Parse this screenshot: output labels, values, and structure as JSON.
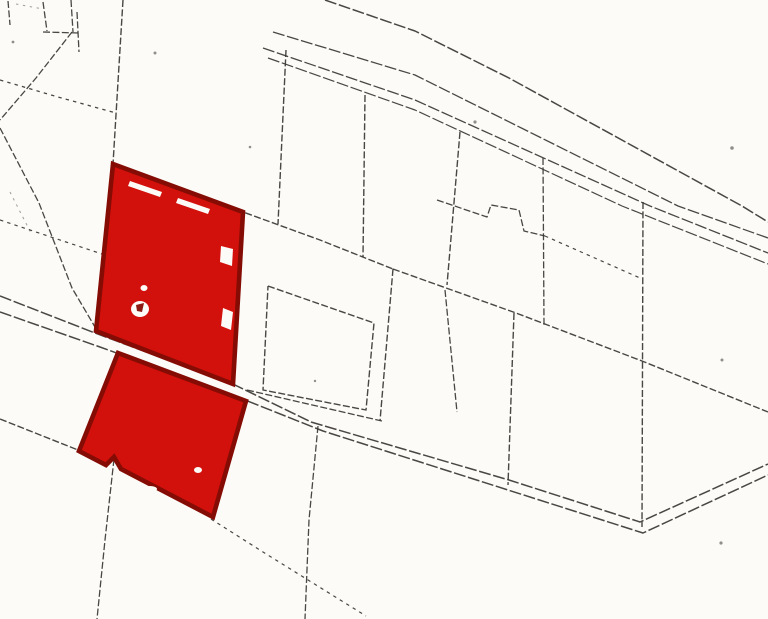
{
  "canvas": {
    "width": 768,
    "height": 619
  },
  "palette": {
    "paper": "#fcfbf8",
    "line": "#3b3733",
    "line_faint": "#918d86",
    "parcel_fill": "#d2100c",
    "parcel_border": "#850c04",
    "scan_mark": "#8d1a12",
    "speck": "#6f6b66"
  },
  "map": {
    "highlighted_parcels": [
      {
        "name": "highlighted-parcel-upper",
        "pts": [
          [
            113,
            164
          ],
          [
            243,
            212
          ],
          [
            233,
            384
          ],
          [
            96,
            331
          ]
        ]
      },
      {
        "name": "highlighted-parcel-lower",
        "pts": [
          [
            118,
            353
          ],
          [
            246,
            401
          ],
          [
            213,
            517
          ],
          [
            121,
            469
          ],
          [
            114,
            457
          ],
          [
            106,
            465
          ],
          [
            79,
            451
          ]
        ]
      }
    ],
    "boundary_lines": [
      {
        "name": "boundary-smallparcel-vert-1",
        "style": "solid",
        "w": 1.3,
        "pts": [
          [
            8,
            1
          ],
          [
            10,
            25
          ]
        ]
      },
      {
        "name": "boundary-smallparcel-top-dash",
        "style": "faint",
        "w": 1.1,
        "pts": [
          [
            16,
            4
          ],
          [
            43,
            9
          ]
        ]
      },
      {
        "name": "boundary-smallparcel-vert-2",
        "style": "solid",
        "w": 1.3,
        "pts": [
          [
            43,
            2
          ],
          [
            47,
            31
          ]
        ]
      },
      {
        "name": "boundary-smallparcel-vert-3",
        "style": "solid",
        "w": 1.3,
        "pts": [
          [
            71,
            0
          ],
          [
            73,
            32
          ]
        ]
      },
      {
        "name": "boundary-smallparcel-horiz",
        "style": "solid",
        "w": 1.3,
        "pts": [
          [
            43,
            32
          ],
          [
            79,
            33
          ]
        ]
      },
      {
        "name": "boundary-smallparcel-vert-4",
        "style": "solid",
        "w": 1.3,
        "pts": [
          [
            77,
            12
          ],
          [
            79,
            52
          ]
        ]
      },
      {
        "name": "boundary-vertical-to-red-corner",
        "style": "solid",
        "w": 1.4,
        "pts": [
          [
            123,
            0
          ],
          [
            118,
            82
          ],
          [
            113,
            164
          ]
        ]
      },
      {
        "name": "boundary-upperleft-diagonal",
        "style": "dashed",
        "w": 1.3,
        "pts": [
          [
            0,
            80
          ],
          [
            58,
            97
          ],
          [
            116,
            113
          ]
        ]
      },
      {
        "name": "boundary-upperleft-steep",
        "style": "solid",
        "w": 1.3,
        "pts": [
          [
            72,
            32
          ],
          [
            36,
            78
          ],
          [
            0,
            120
          ]
        ]
      },
      {
        "name": "boundary-left-long",
        "style": "solid",
        "w": 1.3,
        "pts": [
          [
            0,
            128
          ],
          [
            39,
            203
          ],
          [
            72,
            288
          ],
          [
            95,
            327
          ]
        ]
      },
      {
        "name": "boundary-left-echo",
        "style": "faint",
        "w": 1.1,
        "pts": [
          [
            10,
            192
          ],
          [
            32,
            235
          ]
        ]
      },
      {
        "name": "boundary-dash-to-parcel",
        "style": "dashed",
        "w": 1.2,
        "pts": [
          [
            0,
            220
          ],
          [
            102,
            254
          ]
        ]
      },
      {
        "name": "boundary-main-upper",
        "style": "solid",
        "w": 1.4,
        "pts": [
          [
            113,
            164
          ],
          [
            243,
            212
          ],
          [
            320,
            240
          ],
          [
            393,
            269
          ]
        ]
      },
      {
        "name": "boundary-main-lower-e",
        "style": "solid",
        "w": 1.4,
        "pts": [
          [
            393,
            269
          ],
          [
            516,
            313
          ],
          [
            642,
            361
          ],
          [
            768,
            412
          ]
        ]
      },
      {
        "name": "boundary-vert-284",
        "style": "solid",
        "w": 1.4,
        "pts": [
          [
            286,
            50
          ],
          [
            278,
            224
          ]
        ]
      },
      {
        "name": "boundary-vert-364",
        "style": "solid",
        "w": 1.4,
        "pts": [
          [
            365,
            95
          ],
          [
            363,
            257
          ]
        ]
      },
      {
        "name": "boundary-vert-390",
        "style": "solid",
        "w": 1.4,
        "pts": [
          [
            393,
            269
          ],
          [
            380,
            421
          ]
        ]
      },
      {
        "name": "boundary-vert-453-upper",
        "style": "solid",
        "w": 1.4,
        "pts": [
          [
            460,
            132
          ],
          [
            447,
            285
          ]
        ]
      },
      {
        "name": "boundary-vert-453-lower",
        "style": "solid",
        "w": 1.3,
        "pts": [
          [
            445,
            290
          ],
          [
            457,
            412
          ]
        ]
      },
      {
        "name": "boundary-vert-545",
        "style": "solid",
        "w": 1.3,
        "pts": [
          [
            543,
            158
          ],
          [
            544,
            325
          ]
        ]
      },
      {
        "name": "boundary-vert-643",
        "style": "solid",
        "w": 1.4,
        "pts": [
          [
            643,
            202
          ],
          [
            642,
            527
          ]
        ]
      },
      {
        "name": "boundary-vert-510",
        "style": "solid",
        "w": 1.4,
        "pts": [
          [
            514,
            313
          ],
          [
            508,
            485
          ]
        ]
      },
      {
        "name": "boundary-notch-line",
        "style": "solid",
        "w": 1.3,
        "pts": [
          [
            437,
            200
          ],
          [
            487,
            217
          ],
          [
            491,
            205
          ],
          [
            519,
            210
          ],
          [
            524,
            231
          ],
          [
            545,
            236
          ]
        ]
      },
      {
        "name": "boundary-notch-dash-east",
        "style": "dashed",
        "w": 1.2,
        "pts": [
          [
            545,
            236
          ],
          [
            640,
            278
          ]
        ]
      },
      {
        "name": "boundary-central-parcel",
        "style": "solid",
        "w": 1.4,
        "pts": [
          [
            268,
            286
          ],
          [
            374,
            323
          ],
          [
            366,
            410
          ],
          [
            263,
            390
          ],
          [
            268,
            286
          ]
        ]
      },
      {
        "name": "boundary-bottomleft",
        "style": "solid",
        "w": 1.4,
        "pts": [
          [
            0,
            419
          ],
          [
            78,
            450
          ]
        ]
      },
      {
        "name": "boundary-bottom-dash-cont",
        "style": "dashed",
        "w": 1.2,
        "pts": [
          [
            211,
            519
          ],
          [
            263,
            552
          ],
          [
            366,
            616
          ]
        ]
      },
      {
        "name": "boundary-bottom-vert-from-notch",
        "style": "solid",
        "w": 1.3,
        "pts": [
          [
            114,
            459
          ],
          [
            105,
            540
          ],
          [
            97,
            619
          ]
        ]
      },
      {
        "name": "boundary-bottom-vert-center",
        "style": "solid",
        "w": 1.3,
        "pts": [
          [
            318,
            426
          ],
          [
            309,
            520
          ],
          [
            305,
            619
          ]
        ]
      },
      {
        "name": "boundary-above-road",
        "style": "solid",
        "w": 1.3,
        "pts": [
          [
            247,
            390
          ],
          [
            382,
            421
          ]
        ]
      }
    ],
    "road_lines": [
      {
        "name": "upper-road-line-1",
        "style": "road",
        "w": 1.5,
        "pts": [
          [
            325,
            0
          ],
          [
            415,
            31
          ],
          [
            509,
            78
          ],
          [
            742,
            206
          ],
          [
            768,
            222
          ]
        ]
      },
      {
        "name": "upper-road-line-2",
        "style": "road",
        "w": 1.3,
        "pts": [
          [
            273,
            32
          ],
          [
            415,
            75
          ],
          [
            678,
            206
          ],
          [
            768,
            238
          ]
        ]
      },
      {
        "name": "upper-road-line-3",
        "style": "road",
        "w": 1.3,
        "pts": [
          [
            263,
            48
          ],
          [
            415,
            100
          ],
          [
            650,
            206
          ],
          [
            768,
            253
          ]
        ]
      },
      {
        "name": "upper-road-line-4",
        "style": "road",
        "w": 1.2,
        "pts": [
          [
            268,
            58
          ],
          [
            415,
            110
          ],
          [
            622,
            206
          ],
          [
            768,
            264
          ]
        ]
      },
      {
        "name": "lower-road-upper-edge",
        "style": "road",
        "w": 1.5,
        "pts": [
          [
            0,
            296
          ],
          [
            95,
            333
          ],
          [
            235,
            385
          ],
          [
            311,
            422
          ],
          [
            509,
            480
          ],
          [
            640,
            522
          ],
          [
            768,
            464
          ]
        ]
      },
      {
        "name": "lower-road-lower-edge",
        "style": "road",
        "w": 1.5,
        "pts": [
          [
            0,
            312
          ],
          [
            100,
            347
          ],
          [
            240,
            398
          ],
          [
            323,
            431
          ],
          [
            508,
            490
          ],
          [
            643,
            533
          ],
          [
            768,
            475
          ]
        ]
      }
    ],
    "white_patches": [
      {
        "name": "scan-gap-blob-1",
        "kind": "ellipse",
        "e": [
          140,
          309,
          9,
          8
        ]
      },
      {
        "name": "scan-gap-blob-2",
        "kind": "ellipse",
        "e": [
          144,
          288,
          3.5,
          3
        ]
      },
      {
        "name": "scan-gap-right-1",
        "kind": "poly",
        "pts": [
          [
            221,
            246
          ],
          [
            233,
            249
          ],
          [
            232,
            266
          ],
          [
            220,
            262
          ]
        ]
      },
      {
        "name": "scan-gap-right-2",
        "kind": "poly",
        "pts": [
          [
            223,
            308
          ],
          [
            233,
            312
          ],
          [
            231,
            330
          ],
          [
            221,
            326
          ]
        ]
      },
      {
        "name": "scan-gap-top-sliver-1",
        "kind": "poly",
        "pts": [
          [
            130,
            181
          ],
          [
            162,
            192
          ],
          [
            160,
            197
          ],
          [
            128,
            186
          ]
        ]
      },
      {
        "name": "scan-gap-top-sliver-2",
        "kind": "poly",
        "pts": [
          [
            178,
            198
          ],
          [
            210,
            209
          ],
          [
            208,
            214
          ],
          [
            176,
            203
          ]
        ]
      },
      {
        "name": "scan-gap-lower-1",
        "kind": "ellipse",
        "e": [
          150,
          489,
          7,
          3
        ]
      },
      {
        "name": "scan-gap-lower-2",
        "kind": "ellipse",
        "e": [
          198,
          470,
          4,
          3
        ]
      }
    ],
    "red_marks": [
      {
        "name": "scan-mark-inside-blob",
        "pts": [
          [
            136,
            305
          ],
          [
            144,
            303
          ],
          [
            142,
            312
          ],
          [
            137,
            311
          ]
        ]
      }
    ],
    "specks": [
      [
        155,
        53,
        1.5
      ],
      [
        250,
        147,
        1.3
      ],
      [
        475,
        122,
        1.6
      ],
      [
        732,
        148,
        1.8
      ],
      [
        722,
        360,
        1.5
      ],
      [
        721,
        543,
        1.6
      ],
      [
        315,
        381,
        1.2
      ],
      [
        13,
        42,
        1.4
      ]
    ]
  }
}
